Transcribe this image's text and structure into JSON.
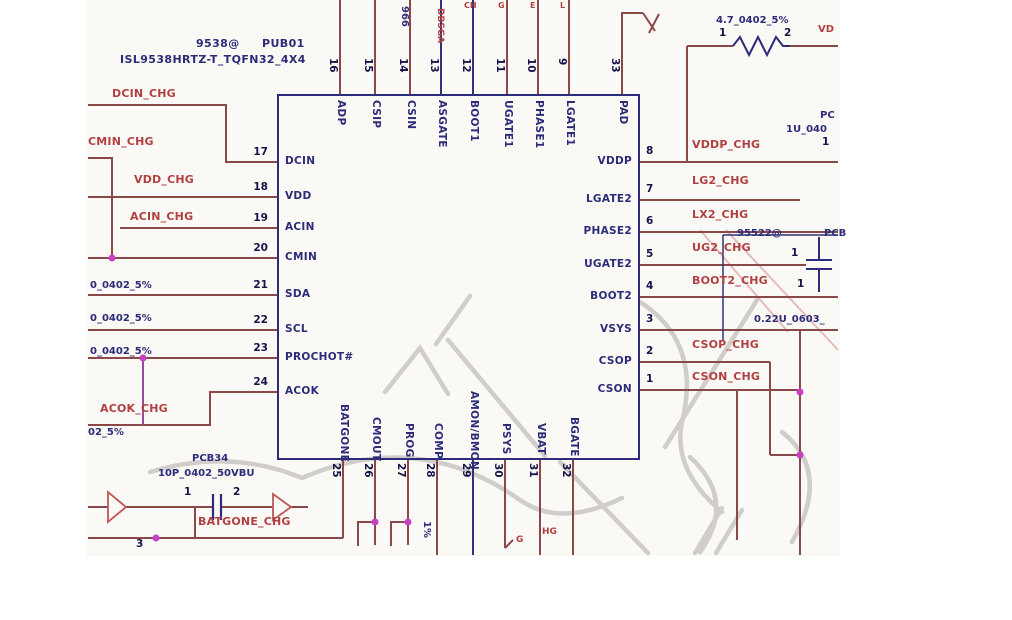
{
  "part": {
    "ref": "9538@",
    "designator": "PUB01",
    "number": "ISL9538HRTZ-T_TQFN32_4X4"
  },
  "pins": {
    "left": [
      {
        "num": "17",
        "name": "DCIN"
      },
      {
        "num": "18",
        "name": "VDD"
      },
      {
        "num": "19",
        "name": "ACIN"
      },
      {
        "num": "20",
        "name": "CMIN"
      },
      {
        "num": "21",
        "name": "SDA"
      },
      {
        "num": "22",
        "name": "SCL"
      },
      {
        "num": "23",
        "name": "PROCHOT#"
      },
      {
        "num": "24",
        "name": "ACOK"
      }
    ],
    "top": [
      {
        "num": "16",
        "name": "ADP"
      },
      {
        "num": "15",
        "name": "CSIP"
      },
      {
        "num": "14",
        "name": "CSIN"
      },
      {
        "num": "13",
        "name": "ASGATE"
      },
      {
        "num": "12",
        "name": "BOOT1"
      },
      {
        "num": "11",
        "name": "UGATE1"
      },
      {
        "num": "10",
        "name": "PHASE1"
      },
      {
        "num": "9",
        "name": "LGATE1"
      },
      {
        "num": "33",
        "name": "PAD"
      }
    ],
    "right": [
      {
        "num": "8",
        "name": "VDDP"
      },
      {
        "num": "7",
        "name": "LGATE2"
      },
      {
        "num": "6",
        "name": "PHASE2"
      },
      {
        "num": "5",
        "name": "UGATE2"
      },
      {
        "num": "4",
        "name": "BOOT2"
      },
      {
        "num": "3",
        "name": "VSYS"
      },
      {
        "num": "2",
        "name": "CSOP"
      },
      {
        "num": "1",
        "name": "CSON"
      }
    ],
    "bottom": [
      {
        "num": "25",
        "name": "BATGONE"
      },
      {
        "num": "26",
        "name": "CMOUT"
      },
      {
        "num": "27",
        "name": "PROG"
      },
      {
        "num": "28",
        "name": "COMP"
      },
      {
        "num": "29",
        "name": "AMON/BMON"
      },
      {
        "num": "30",
        "name": "PSYS"
      },
      {
        "num": "31",
        "name": "VBAT"
      },
      {
        "num": "32",
        "name": "BGATE"
      }
    ]
  },
  "net_labels": [
    "DCIN_CHG",
    "CMIN_CHG",
    "VDD_CHG",
    "ACIN_CHG",
    "ACOK_CHG",
    "BATGONE_CHG",
    "VDDP_CHG",
    "LG2_CHG",
    "LX2_CHG",
    "UG2_CHG",
    "BOOT2_CHG",
    "CSOP_CHG",
    "CSON_CHG"
  ],
  "component_labels": [
    "0_0402_5%",
    "0_0402_5%",
    "0_0402_5%",
    "02_5%",
    "PCB34",
    "10P_0402_50VBU",
    "4.7_0402_5%",
    "95522@",
    "PCB",
    "0.22U_0603_",
    "PC",
    "1U_040",
    "966",
    "1%"
  ],
  "pin_refs": [
    "1",
    "2",
    "1",
    "1",
    "1",
    "1",
    "2",
    "3"
  ],
  "fragments": [
    "DBSGA",
    "CH",
    "G",
    "E",
    "L",
    "VD",
    "G",
    "HG"
  ],
  "colors": {
    "net_label": "#b14040",
    "navy": "#2c2c78",
    "wire": "#8a4848",
    "wire_navy": "#32327a",
    "junction": "#c343c3",
    "watermark": "#d0cdca",
    "triangle": "#c05555"
  }
}
